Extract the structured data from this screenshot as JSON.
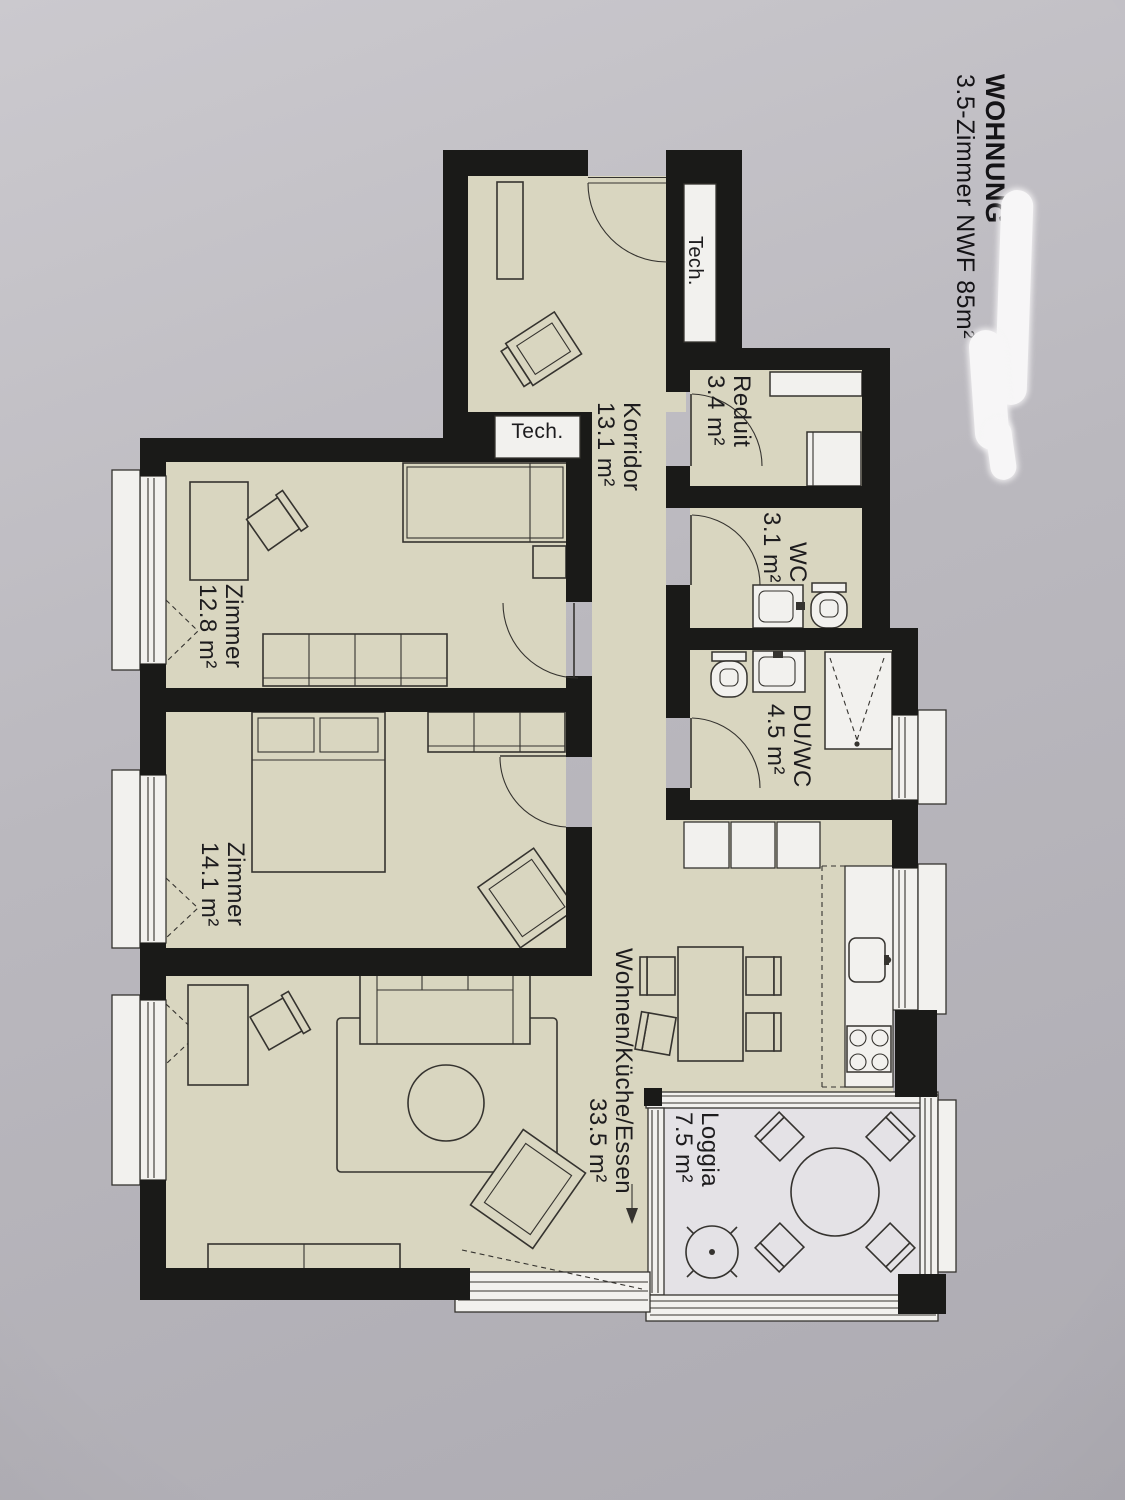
{
  "title": {
    "project": "WOHNUNG",
    "subtitle": "3.5-Zimmer NWF 85m²"
  },
  "rooms": {
    "korridor": {
      "name": "Korridor",
      "area": "13.1 m²"
    },
    "reduit": {
      "name": "Reduit",
      "area": "3.4 m²"
    },
    "wc": {
      "name": "WC",
      "area": "3.1 m²"
    },
    "duwc": {
      "name": "DU/WC",
      "area": "4.5 m²"
    },
    "zimmer1": {
      "name": "Zimmer",
      "area": "12.8 m²"
    },
    "zimmer2": {
      "name": "Zimmer",
      "area": "14.1 m²"
    },
    "wohnen": {
      "name": "Wohnen/Küche/Essen",
      "area": "33.5 m²"
    },
    "loggia": {
      "name": "Loggia",
      "area": "7.5 m²"
    }
  },
  "tech": {
    "niche": "Tech.",
    "shaft": "Tech."
  },
  "colors": {
    "floor": "#d9d6c0",
    "wall": "#1a1a18",
    "paper": "#bab8be",
    "loggia_floor": "#e4e2e6",
    "fixture": "#f2f1ee",
    "line": "#35332f"
  }
}
